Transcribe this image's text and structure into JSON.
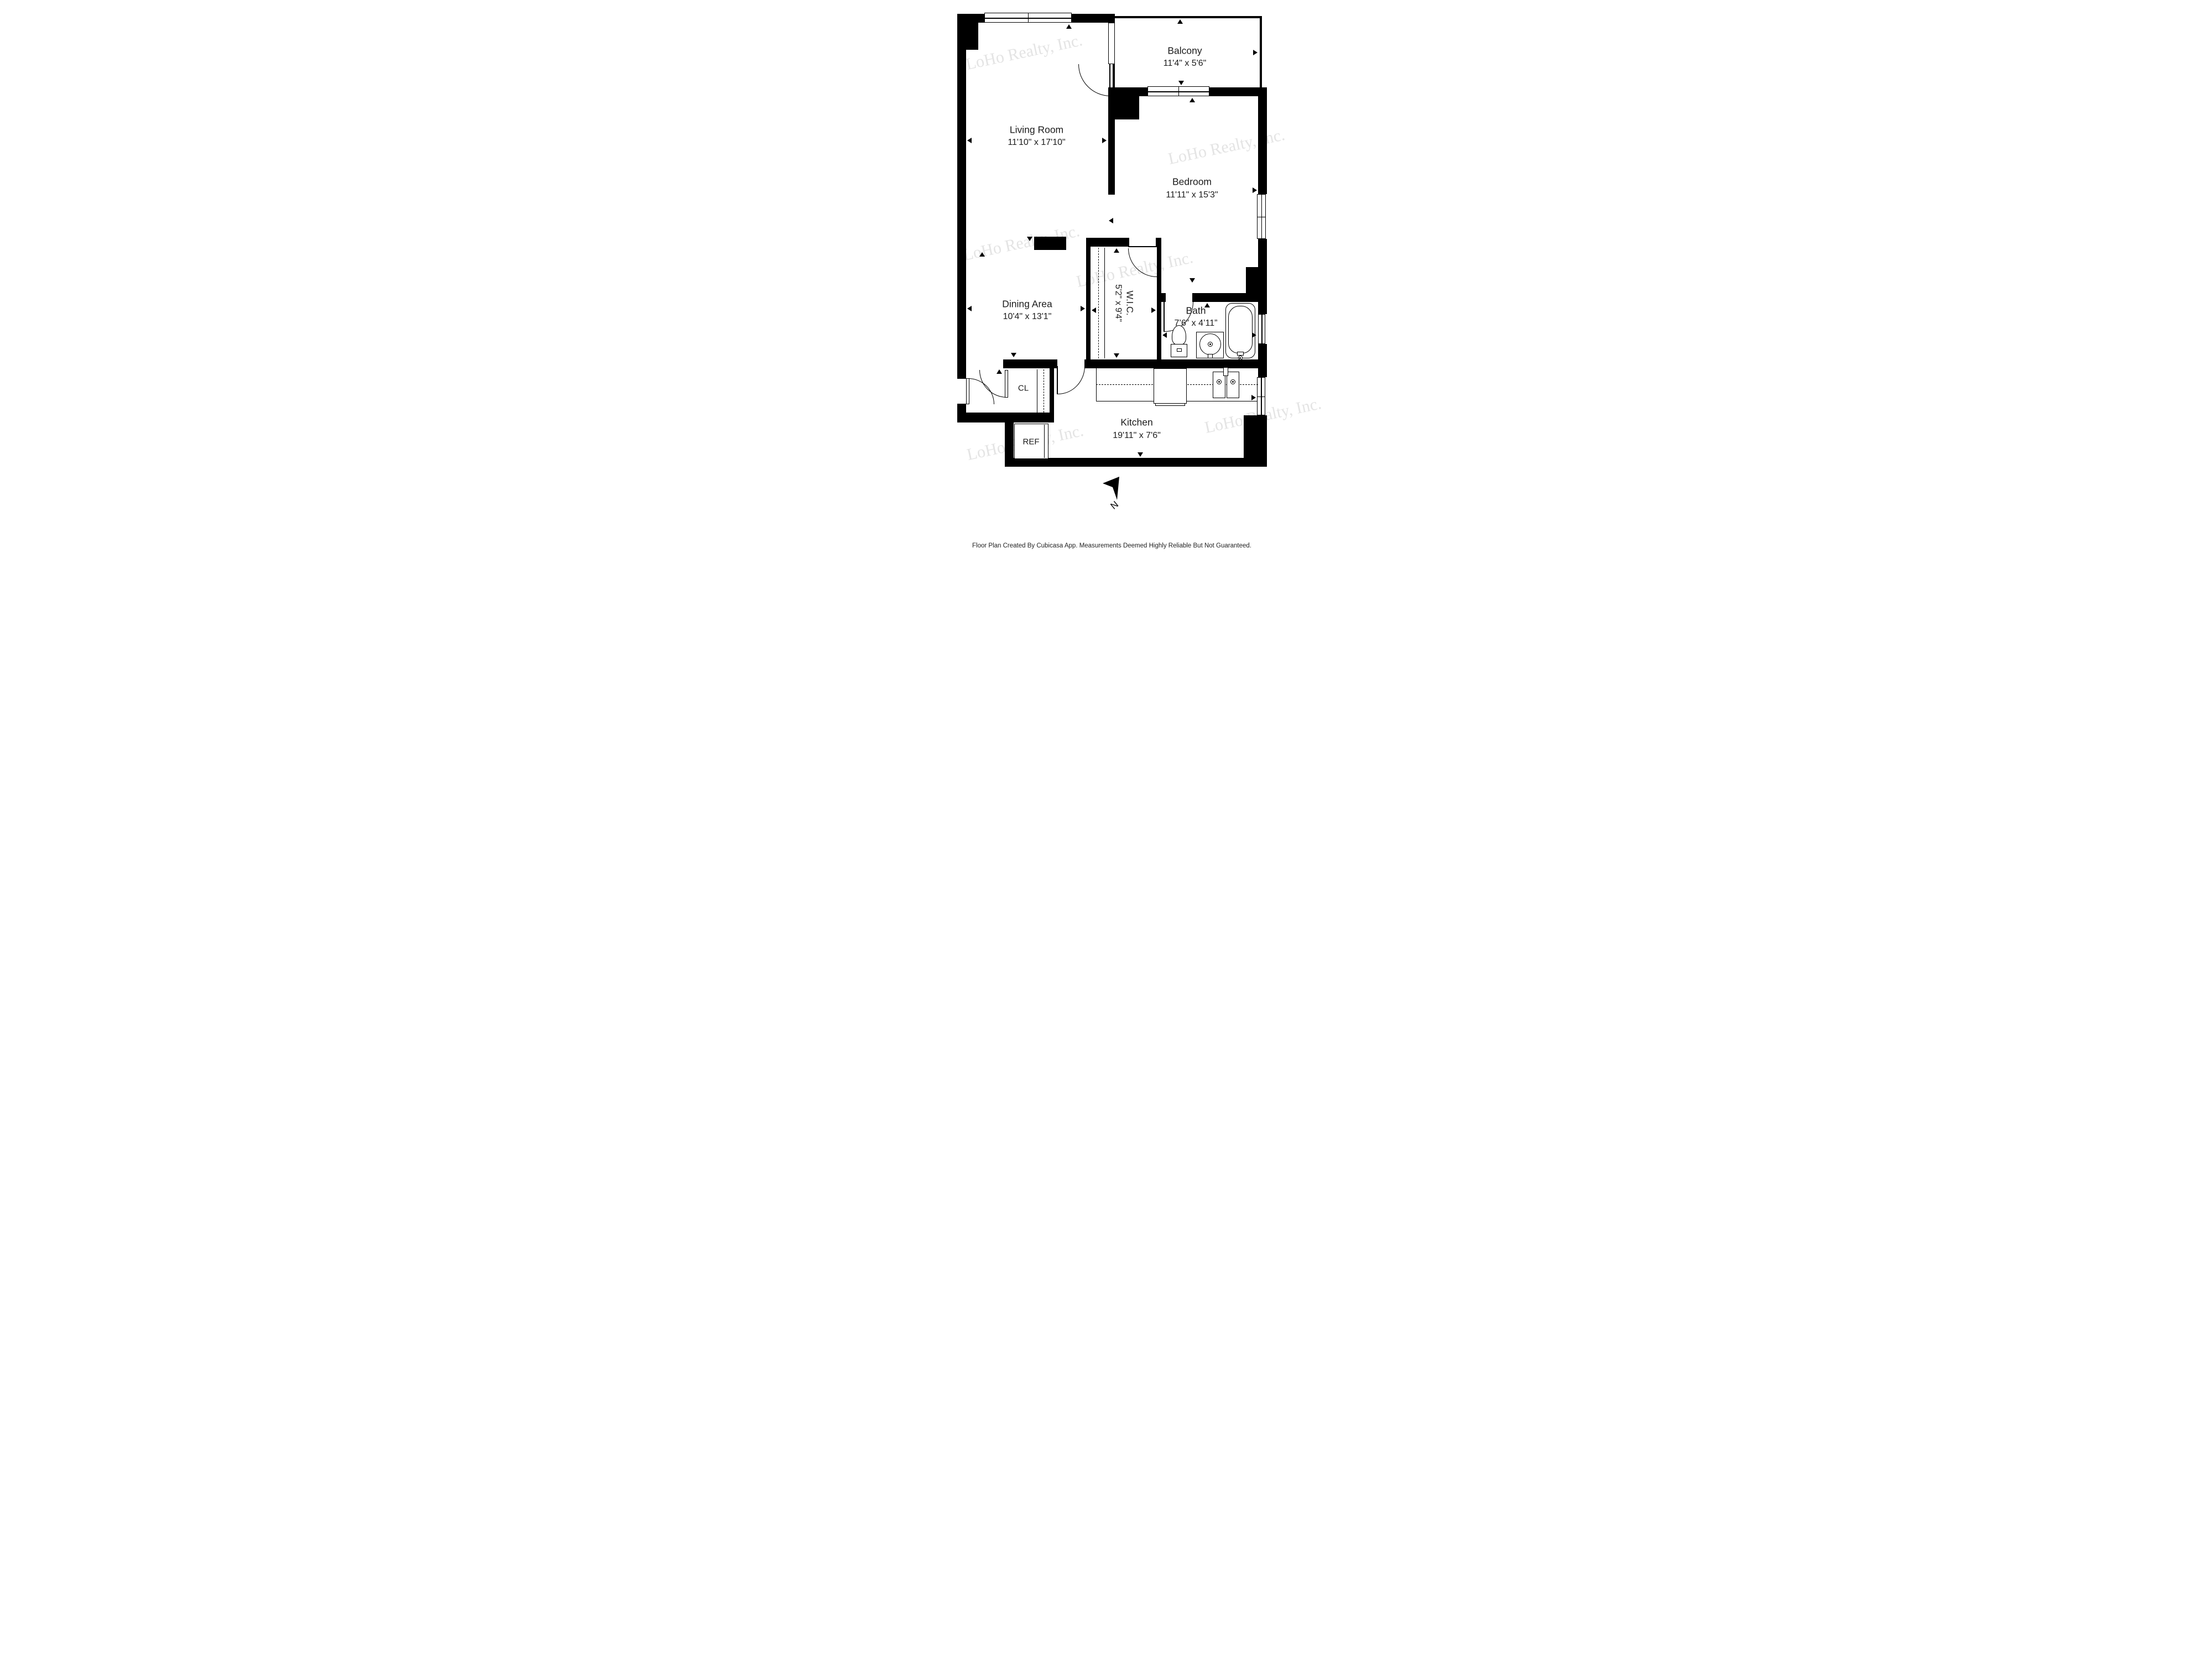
{
  "watermark": {
    "text": "LoHo Realty, Inc."
  },
  "compass": {
    "label": "N"
  },
  "footer": {
    "text": "Floor Plan Created By Cubicasa App. Measurements Deemed Highly Reliable But Not Guaranteed."
  },
  "rooms": {
    "living": {
      "name": "Living Room",
      "dims": "11'10\" x 17'10\""
    },
    "balcony": {
      "name": "Balcony",
      "dims": "11'4\" x 5'6\""
    },
    "bedroom": {
      "name": "Bedroom",
      "dims": "11'11\" x 15'3\""
    },
    "dining": {
      "name": "Dining Area",
      "dims": "10'4\" x 13'1\""
    },
    "wic": {
      "name": "W.I.C.",
      "dims": "5'2\" x 9'4\""
    },
    "bath": {
      "name": "Bath",
      "dims": "7’6” x 4’11”"
    },
    "kitchen": {
      "name": "Kitchen",
      "dims": "19'11\" x 7'6\""
    },
    "closet": {
      "label": "CL"
    },
    "fridge": {
      "label": "REF"
    }
  }
}
